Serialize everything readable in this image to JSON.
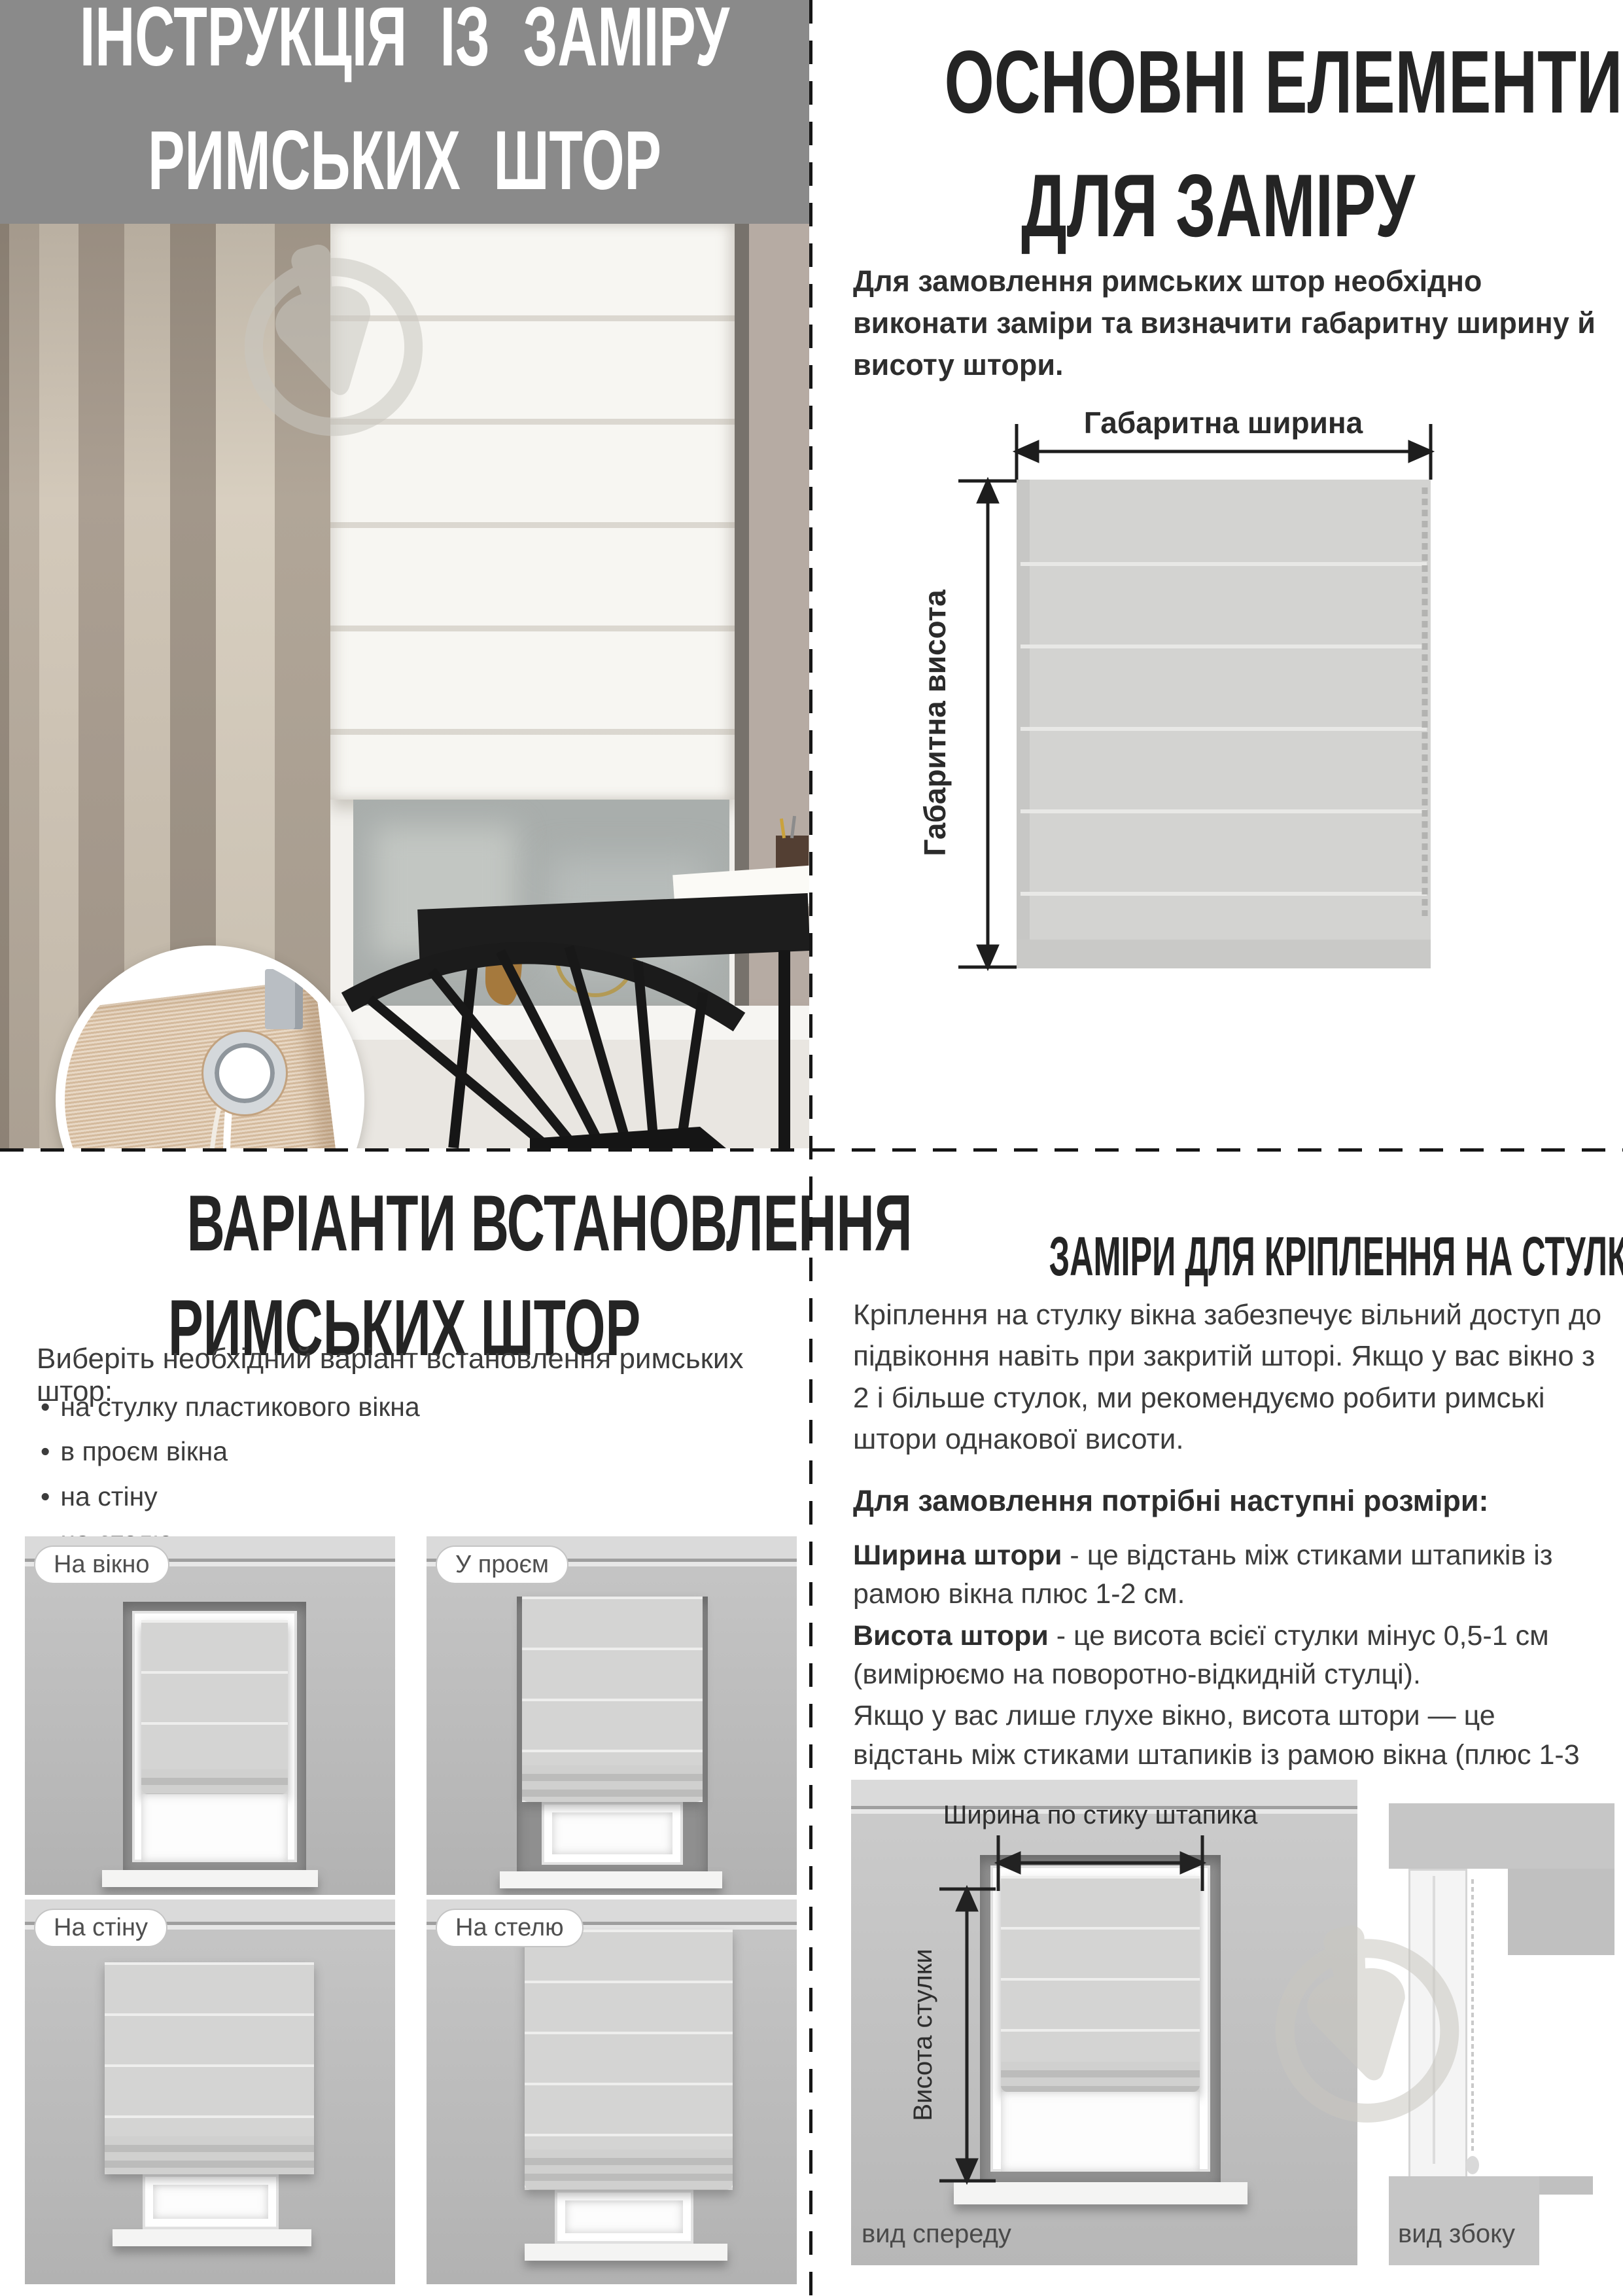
{
  "colors": {
    "header_bg": "#8a8a8a",
    "title_text": "#ffffff",
    "heading_text": "#242424",
    "body_text": "#3a3a3a",
    "divider": "#161616",
    "diagram_line": "#1d1d1d",
    "blind_fill": "#d3d3d1",
    "pill_border": "#c4c4c4",
    "view_label_text": "#4a4a4a"
  },
  "top_left": {
    "title_line1": "ІНСТРУКЦІЯ ІЗ ЗАМІРУ",
    "title_line2": "РИМСЬКИХ ШТОР"
  },
  "top_right": {
    "heading_line1": "ОСНОВНІ ЕЛЕМЕНТИ",
    "heading_line2": "ДЛЯ ЗАМІРУ",
    "intro": "Для замовлення римських штор необхідно виконати заміри та визначити габаритну ширину й висоту штори.",
    "diagram": {
      "width_label": "Габаритна ширина",
      "height_label": "Габаритна висота"
    }
  },
  "bottom_left": {
    "heading_line1": "ВАРІАНТИ ВСТАНОВЛЕННЯ",
    "heading_line2": "РИМСЬКИХ ШТОР",
    "intro": "Виберіть необхідний варіант встановлення римських штор:",
    "bullets": [
      "на стулку пластикового вікна",
      "в проєм вікна",
      "на стіну",
      "на стелю"
    ],
    "variants": [
      {
        "label": "На вікно"
      },
      {
        "label": "У проєм"
      },
      {
        "label": "На стіну"
      },
      {
        "label": "На стелю"
      }
    ]
  },
  "bottom_right": {
    "heading": "ЗАМІРИ ДЛЯ КРІПЛЕННЯ НА СТУЛКУ ВІКНА",
    "para1": "Кріплення на стулку вікна забезпечує вільний доступ до підвіконня навіть при закритій шторі. Якщо у вас вікно з 2 і більше стулок, ми рекомендуємо робити римські штори однакової висоти.",
    "order_intro": "Для замовлення потрібні наступні розміри:",
    "width_term": "Ширина штори",
    "width_def": " - це відстань між стиками штапиків із рамою вікна плюс 1-2 см.",
    "height_term": "Висота штори",
    "height_def": " - це висота всієї стулки мінус 0,5-1 см (вимірюємо на поворотно-відкидній стулці).",
    "para2": "Якщо у вас лише глухе вікно, висота штори — це відстань між стиками штапиків із рамою вікна (плюс 1-3 см).",
    "diagram": {
      "width_label": "Ширина по стику штапика",
      "height_label": "Висота стулки",
      "front_view_label": "вид спереду",
      "side_view_label": "вид збоку"
    }
  }
}
